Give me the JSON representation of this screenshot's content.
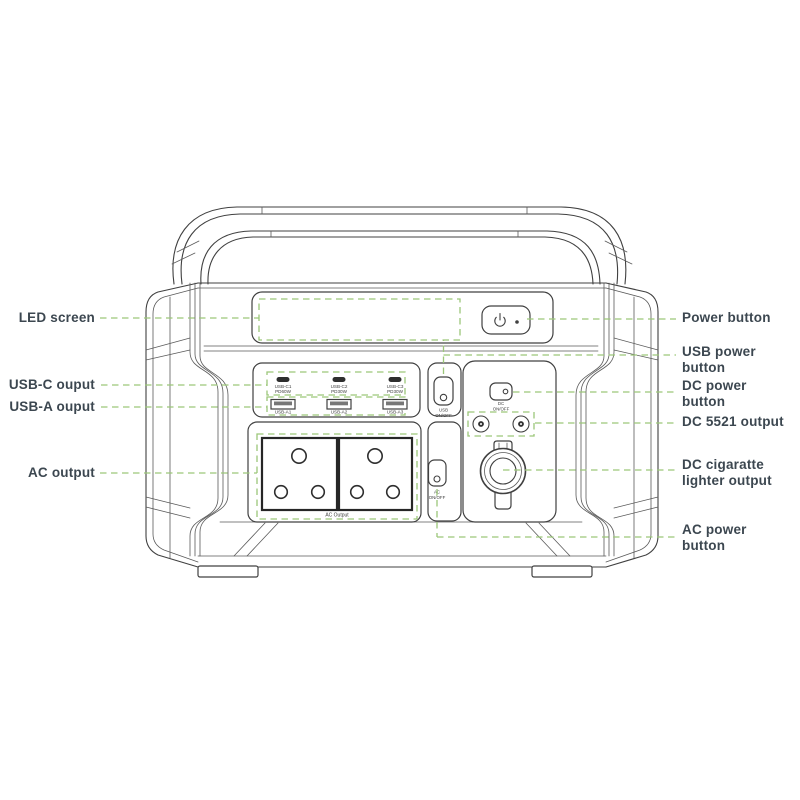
{
  "title": "Portable power station port diagram",
  "colors": {
    "leader_green": "#9cc779",
    "line_gray": "#404040",
    "label_text": "#3c4750"
  },
  "callouts": {
    "left": [
      {
        "lines": [
          "LED screen"
        ]
      },
      {
        "lines": [
          "USB-C ouput"
        ]
      },
      {
        "lines": [
          "USB-A ouput"
        ]
      },
      {
        "lines": [
          "AC output"
        ]
      }
    ],
    "right": [
      {
        "lines": [
          "Power button"
        ]
      },
      {
        "lines": [
          "USB power",
          "button"
        ]
      },
      {
        "lines": [
          "DC power",
          "button"
        ]
      },
      {
        "lines": [
          "DC 5521 output"
        ]
      },
      {
        "lines": [
          "DC cigaratte",
          "lighter output"
        ]
      },
      {
        "lines": [
          "AC power",
          "button"
        ]
      }
    ]
  },
  "device": {
    "usb_c_ports": [
      {
        "id": "USB-C1",
        "power": "PD60W"
      },
      {
        "id": "USB-C2",
        "power": "PD30W"
      },
      {
        "id": "USB-C3",
        "power": "PD30W"
      }
    ],
    "usb_a_ports": [
      {
        "id": "USB-A1"
      },
      {
        "id": "USB-A2"
      },
      {
        "id": "USB-A3"
      }
    ],
    "ac_output_label": "AC Output",
    "buttons": {
      "usb": {
        "line1": "USB",
        "line2": "ON/OFF"
      },
      "dc": {
        "line1": "DC",
        "line2": "ON/OFF"
      },
      "ac": {
        "line1": "AC",
        "line2": "ON/OFF"
      }
    },
    "icons": {
      "power": "power-symbol"
    }
  }
}
